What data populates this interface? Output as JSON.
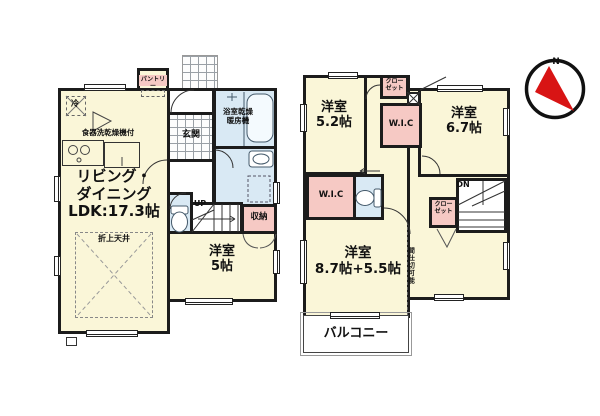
{
  "floor1": {
    "pantry": "パントリー",
    "fridge": "冷",
    "dishwasher": "食器洗乾燥機付",
    "bathroom": "浴室乾燥\n暖房機",
    "genkan": "玄関",
    "ldk": "リビング・\nダイニング\nLDK:17.3帖",
    "coffered_ceiling": "折上天井",
    "stairs_up": "UP",
    "storage": "収納",
    "bedroom5": "洋室\n5帖"
  },
  "floor2": {
    "bedroom52": "洋室\n5.2帖",
    "bedroom67": "洋室\n6.7帖",
    "closet_top": "クロー\nゼット",
    "closet_mid": "クロー\nゼット",
    "wic_top": "W.I.C",
    "wic_left": "W.I.C",
    "stairs_down": "DN",
    "bedroom_main": "洋室\n8.7帖+5.5帖",
    "partition_note": "間仕切可能",
    "balcony": "バルコニー"
  },
  "compass": {
    "north": "N"
  },
  "colors": {
    "room_fill": "#faf6d8",
    "closet_fill": "#f6c9c4",
    "wet_area_fill": "#d9e9f4",
    "wall": "#1c1c1c",
    "north_arrow": "#d81414"
  }
}
